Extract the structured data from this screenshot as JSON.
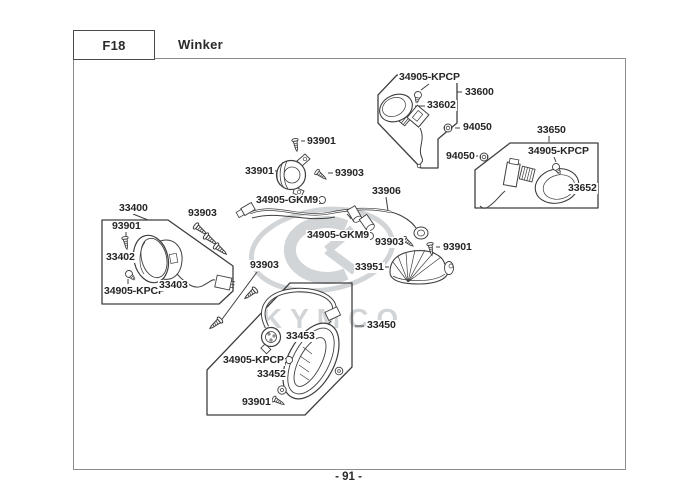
{
  "page": {
    "section_code": "F18",
    "section_title": "Winker",
    "page_number": "- 91 -"
  },
  "watermark": {
    "brand": "KYMCO"
  },
  "diagram": {
    "part_labels": [
      {
        "id": "bulb-33600-box",
        "text": "34905-KPCP"
      },
      {
        "id": "assy-33600",
        "text": "33600"
      },
      {
        "id": "socket-33602",
        "text": "33602"
      },
      {
        "id": "nut-94050-a",
        "text": "94050"
      },
      {
        "id": "nut-94050-b",
        "text": "94050"
      },
      {
        "id": "assy-33650",
        "text": "33650"
      },
      {
        "id": "bulb-33650-box",
        "text": "34905-KPCP"
      },
      {
        "id": "lens-33652",
        "text": "33652"
      },
      {
        "id": "screw-93901-a",
        "text": "93901"
      },
      {
        "id": "relay-33901",
        "text": "33901"
      },
      {
        "id": "screw-93903-a",
        "text": "93903"
      },
      {
        "id": "bulb-34905-gkm9-a",
        "text": "34905-GKM9"
      },
      {
        "id": "harness-33906",
        "text": "33906"
      },
      {
        "id": "bulb-34905-gkm9-b",
        "text": "34905-GKM9"
      },
      {
        "id": "screw-93903-b",
        "text": "93903"
      },
      {
        "id": "screw-93901-b",
        "text": "93901"
      },
      {
        "id": "lamp-33951",
        "text": "33951"
      },
      {
        "id": "assy-33400",
        "text": "33400"
      },
      {
        "id": "screw-93901-c",
        "text": "93901"
      },
      {
        "id": "lens-33402",
        "text": "33402"
      },
      {
        "id": "bulb-33400-box",
        "text": "34905-KPCP"
      },
      {
        "id": "body-33403",
        "text": "33403"
      },
      {
        "id": "screws-93903-c",
        "text": "93903"
      },
      {
        "id": "screws-93903-d",
        "text": "93903"
      },
      {
        "id": "assy-33450",
        "text": "33450"
      },
      {
        "id": "seal-33453",
        "text": "33453"
      },
      {
        "id": "bulb-33450-box",
        "text": "34905-KPCP"
      },
      {
        "id": "lens-33452",
        "text": "33452"
      },
      {
        "id": "screw-93901-d",
        "text": "93901"
      }
    ]
  }
}
